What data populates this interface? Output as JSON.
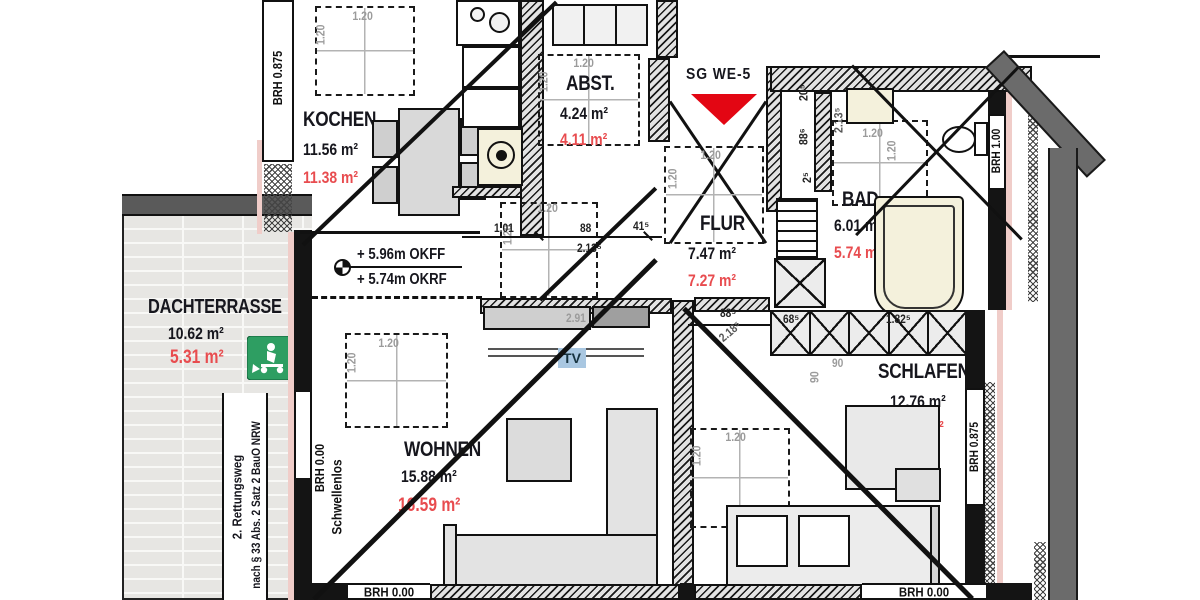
{
  "title": "SG WE-5",
  "rooms": {
    "kochen": {
      "name": "KOCHEN",
      "area": "11.56 m²",
      "area_calc": "11.38 m²"
    },
    "abst": {
      "name": "ABST.",
      "area": "4.24 m²",
      "area_calc": "4.11 m²"
    },
    "flur": {
      "name": "FLUR",
      "area": "7.47 m²",
      "area_calc": "7.27 m²"
    },
    "bad": {
      "name": "BAD",
      "area": "6.01 m²",
      "area_calc": "5.74 m²"
    },
    "schlafen": {
      "name": "SCHLAFEN",
      "area": "12.76 m²",
      "area_calc": "12.87 m²"
    },
    "wohnen": {
      "name": "WOHNEN",
      "area": "15.88 m²",
      "area_calc": "16.59 m²"
    },
    "dachterrasse": {
      "name": "DACHTERRASSE",
      "area": "10.62 m²",
      "area_calc": "5.31 m²"
    }
  },
  "levels": {
    "okff": "+ 5.96m OKFF",
    "okrf": "+ 5.74m OKRF"
  },
  "sills": {
    "kitchen": "BRH 0.875",
    "bath": "BRH 1.00",
    "bedroom": "BRH 0.875",
    "terrace": "BRH 0.00",
    "living": "BRH 0.00",
    "bedroom_south": "BRH 0.00",
    "barrier_free": "Schwellenlos"
  },
  "escape_route": {
    "line1": "2. Rettungsweg",
    "line2": "nach § 33 Abs. 2 Satz 2 BauO NRW"
  },
  "dims": {
    "sky": "1.20",
    "len_101": "1.01",
    "len_88": "88",
    "len_41_5": "41⁵",
    "len_213_5": "2.13⁵",
    "len_20_5": "20⁵",
    "len_88_6": "88⁶",
    "len_2_5": "2⁵",
    "len_88_5": "88⁵",
    "len_218_5": "2.18⁵",
    "len_68_5": "68⁵",
    "len_182_5": "1.82⁵",
    "len_90": "90",
    "len_29": "2.91"
  },
  "labels": {
    "tv": "TV"
  },
  "colors": {
    "red_text": "#e84c4f",
    "dim_grey": "#9b9b9b",
    "exit_green": "#2e9e62",
    "tv_bg": "#a9c7e1",
    "tub": "#f4f1dc",
    "roof_grey": "#6b6b6b",
    "insulation_pink": "#f0cdc9"
  }
}
